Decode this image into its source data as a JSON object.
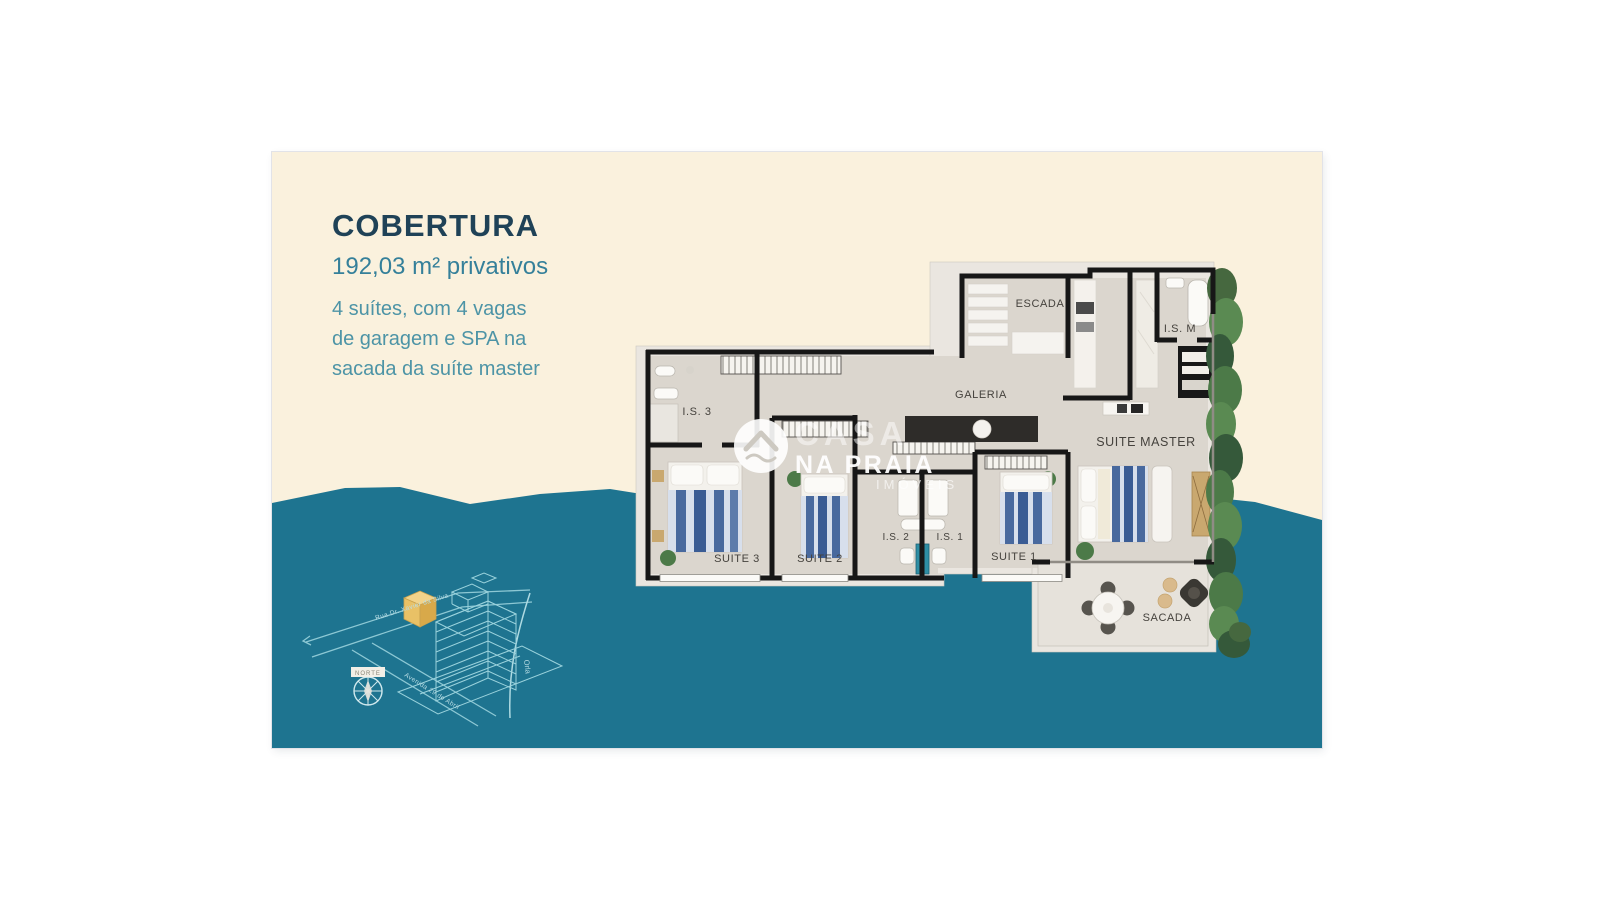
{
  "panel": {
    "title": "COBERTURA",
    "area": "192,03 m² privativos",
    "desc_line1": "4 suítes, com 4 vagas",
    "desc_line2": "de garagem e SPA na",
    "desc_line3": "sacada da suíte master"
  },
  "floorplan": {
    "labels": {
      "escada": "ESCADA",
      "is_m": "I.S. M",
      "galeria": "GALERIA",
      "is_3": "I.S. 3",
      "suite_master": "SUITE MASTER",
      "suite_3": "SUITE 3",
      "suite_2": "SUITE 2",
      "is_2": "I.S. 2",
      "is_1": "I.S. 1",
      "suite_1": "SUITE 1",
      "sacada": "SACADA"
    }
  },
  "watermark": {
    "brand_top": "CASA",
    "brand_main": "NA PRAIA",
    "brand_sub": "IMÓVEIS"
  },
  "site_map": {
    "street_1": "Rua Dr. Xavier da Silva",
    "street_2": "Avenida 29 de Abril",
    "shore_label": "Orla",
    "compass_label": "NORTE"
  },
  "colors": {
    "cream": "#faf1dd",
    "teal": "#1e7490",
    "title": "#1f4257",
    "subtitle": "#35809a",
    "body_text": "#4d94a6",
    "floor": "#dbd6ce",
    "apron": "#eae6e0",
    "wall": "#171717",
    "bed_blue": "#46689f",
    "bed_blue_dark": "#3a5c94",
    "plant_green": "#4c7a48",
    "map_line": "#9ad2dc",
    "highlight": "#ecc46b"
  }
}
